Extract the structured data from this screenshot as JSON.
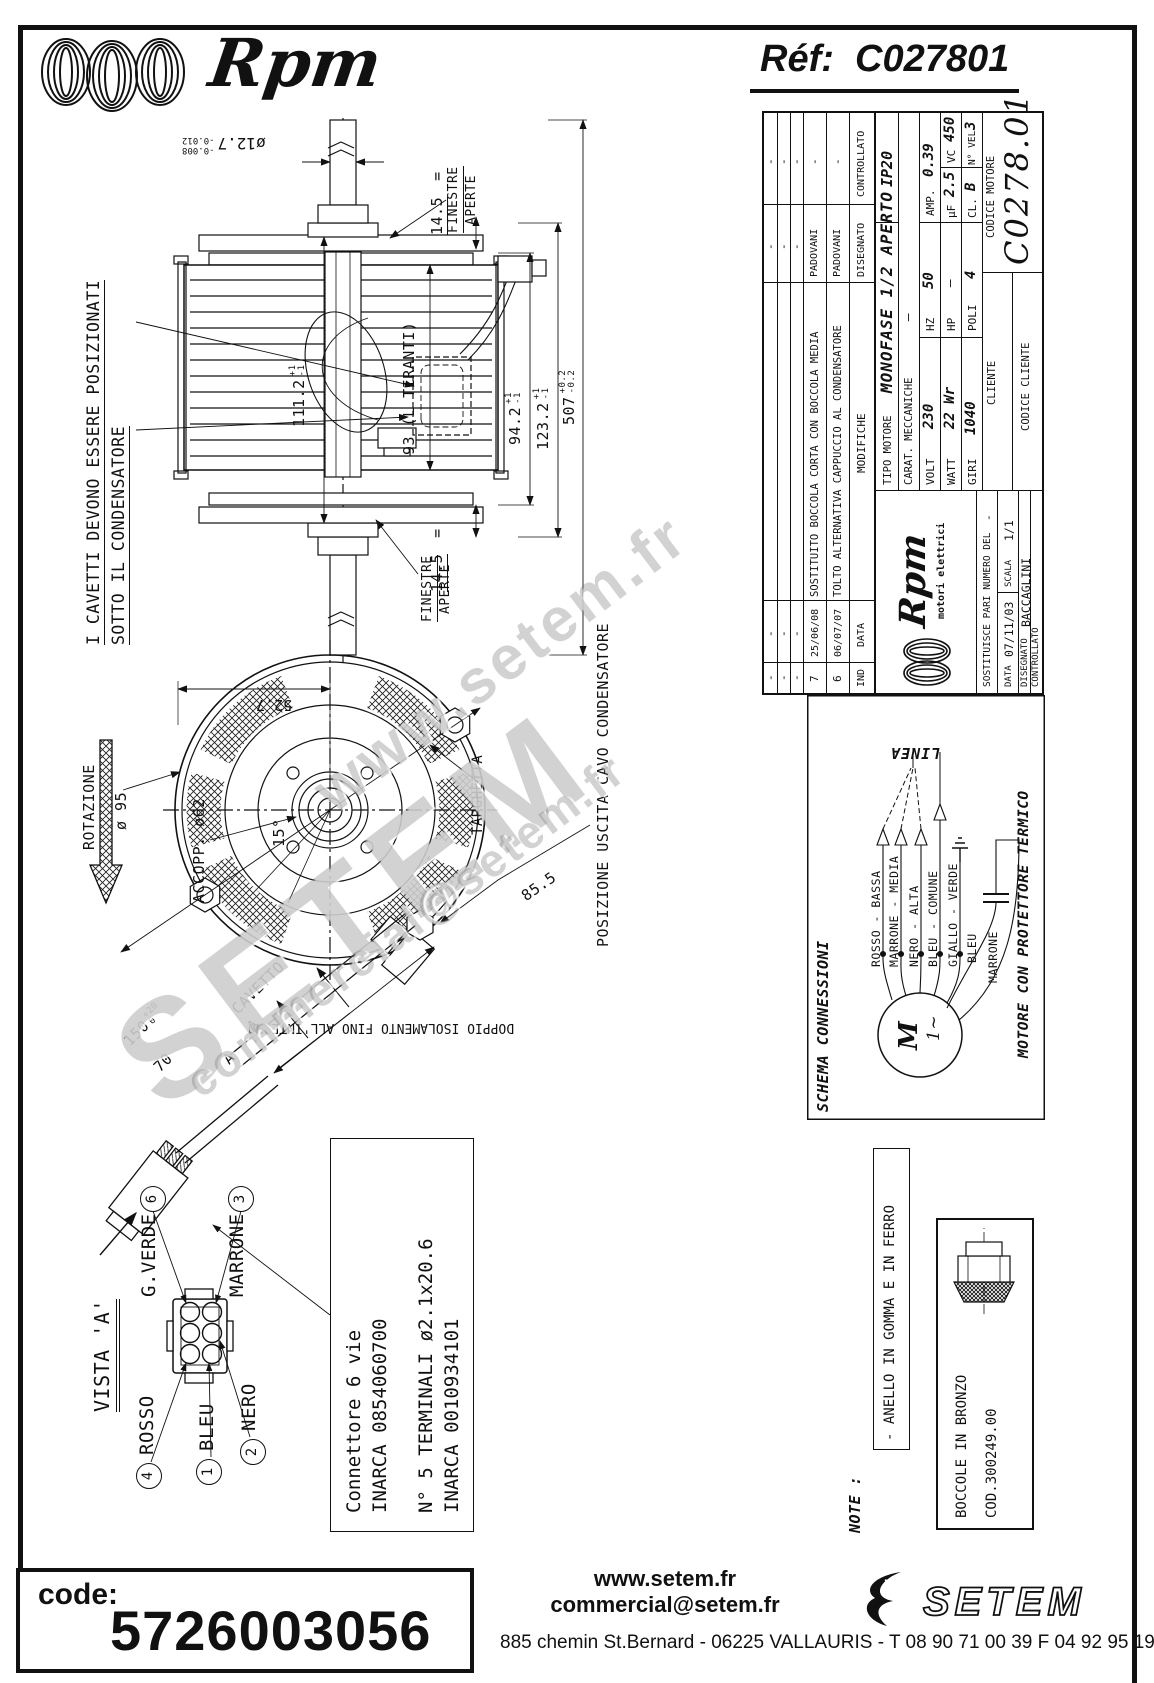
{
  "header": {
    "brand": "Rpm",
    "ref_label": "Réf:",
    "ref_value": "C027801"
  },
  "watermark": {
    "line1": "www.setem.fr",
    "line2": "SETEM",
    "line3": "commercial@setem.fr"
  },
  "side_view": {
    "note1": "I CAVETTI DEVONO ESSERE POSIZIONATI",
    "note2": "SOTTO IL CONDENSATORE",
    "shaft_dia": {
      "v": "ø12.7",
      "tp": "-0.008",
      "tm": "-0.012"
    },
    "d93": "93 (L TIRANTI)",
    "d1112": {
      "v": "111.2",
      "tp": "+1",
      "tm": "-1"
    },
    "d942": {
      "v": "94.2",
      "tp": "+1",
      "tm": "-1"
    },
    "d1232": {
      "v": "123.2",
      "tp": "+1",
      "tm": "-1"
    },
    "d507": {
      "v": "507",
      "tp": "+0.2",
      "tm": "-0.2"
    },
    "d145a": "14.5",
    "d145a_eq": "=",
    "d145b": "14.5",
    "d145b_eq": "=",
    "fin1a": "FINESTRE",
    "fin1b": "APERTE",
    "fin2a": "FINESTRE",
    "fin2b": "APERTE"
  },
  "front_view": {
    "rotazione": "ROTAZIONE",
    "d95": "ø 95",
    "accopp": "ACCOPP. ø62",
    "a15": "15°",
    "d527": "52.7",
    "targhetta": "TARGHETTA",
    "d855": "85.5",
    "cavetto": "CAVETTO",
    "d150": {
      "v": "150",
      "tp": "+20",
      "tm": "0"
    },
    "d70": "70",
    "a1": "A",
    "a2": "A",
    "posizione": "POSIZIONE USCITA CAVO CONDENSATORE",
    "doppio": "DOPPIO ISOLAMENTO FINO ALL'INTERNO"
  },
  "connector": {
    "vista": "VISTA 'A'",
    "pin6_num": "6",
    "pin6_label": "G.VERDE",
    "pin3_num": "3",
    "pin3_label": "MARRONE",
    "pin4_num": "4",
    "pin4_label": "ROSSO",
    "pin1_num": "1",
    "pin1_label": "BLEU",
    "pin2_num": "2",
    "pin2_label": "NERO",
    "box1": "Connettore 6 vie",
    "box2": "INARCA 0854060700",
    "box3": "N° 5 TERMINALI ø2.1x20.6",
    "box4": "INARCA 0010934101"
  },
  "schema": {
    "title": "SCHEMA CONNESSIONI",
    "linea": "LINEA",
    "w1": "ROSSO - BASSA",
    "w2": "MARRONE - MEDIA",
    "w3": "NERO - ALTA",
    "w4": "BLEU - COMUNE",
    "w5": "GIALLO - VERDE",
    "cap1": "BLEU",
    "cap2": "MARRONE",
    "m": "M",
    "m_sub": "1~",
    "protettore": "MOTORE CON PROTETTORE TERMICO"
  },
  "titleblock": {
    "rev": [
      {
        "ind": "-",
        "date": "-",
        "mod": "",
        "des": "-",
        "con": "-"
      },
      {
        "ind": "-",
        "date": "-",
        "mod": "",
        "des": "-",
        "con": "-"
      },
      {
        "ind": "-",
        "date": "-",
        "mod": "",
        "des": "-",
        "con": "-"
      },
      {
        "ind": "7",
        "date": "25/06/08",
        "mod": "SOSTITUITO BOCCOLA CORTA CON BOCCOLA MEDIA",
        "des": "PADOVANI",
        "con": "-"
      },
      {
        "ind": "6",
        "date": "06/07/07",
        "mod": "TOLTO ALTERNATIVA CAPPUCCIO AL CONDENSATORE",
        "des": "PADOVANI",
        "con": "-"
      }
    ],
    "h_ind": "IND",
    "h_date": "DATA",
    "h_mod": "MODIFICHE",
    "h_des": "DISEGNATO",
    "h_con": "CONTROLLATO",
    "tipo_label": "TIPO MOTORE",
    "tipo": "MONOFASE 1/2 APERTO",
    "ip": "IP20",
    "carat_label": "CARAT. MECCANICHE",
    "carat": "—",
    "volt_label": "VOLT",
    "volt": "230",
    "hz_label": "HZ",
    "hz": "50",
    "amp_label": "AMP.",
    "amp": "0.39",
    "watt_label": "WATT",
    "watt": "22 Wr",
    "hp_label": "HP",
    "hp": "—",
    "uf_label": "μF",
    "uf": "2.5",
    "vc_label": "VC",
    "vc": "450",
    "giri_label": "GIRI",
    "giri": "1040",
    "poli_label": "POLI",
    "poli": "4",
    "cl_label": "CL.",
    "cl": "B",
    "vel_label": "N° VEL.",
    "vel": "3",
    "cliente": "CLIENTE",
    "codice_motore_label": "CODICE MOTORE",
    "codice_motore": "C0278.01",
    "codice_cliente": "CODICE CLIENTE",
    "logo": "Rpm",
    "logo_sub": "motori elettrici",
    "sost_label": "SOSTITUISCE PARI NUMERO DEL",
    "sost": "-",
    "data_label": "DATA",
    "data": "07/11/03",
    "scala_label": "SCALA",
    "scala": "1/1",
    "des_label": "DISEGNATO",
    "des": "BACCAGLINI",
    "con_label": "CONTROLLATO"
  },
  "note": {
    "label": "NOTE :",
    "anello": "- ANELLO IN GOMMA E IN FERRO",
    "boccole1": "BOCCOLE IN BRONZO",
    "boccole2": "COD.300249.00"
  },
  "footer": {
    "code_label": "code:",
    "code": "5726003056",
    "site": "www.setem.fr",
    "email": "commercial@setem.fr",
    "brand": "SETEM",
    "address": "885 chemin St.Bernard  -  06225 VALLAURIS  -  T 08 90 71 00 39   F 04 92 95 19 39"
  }
}
